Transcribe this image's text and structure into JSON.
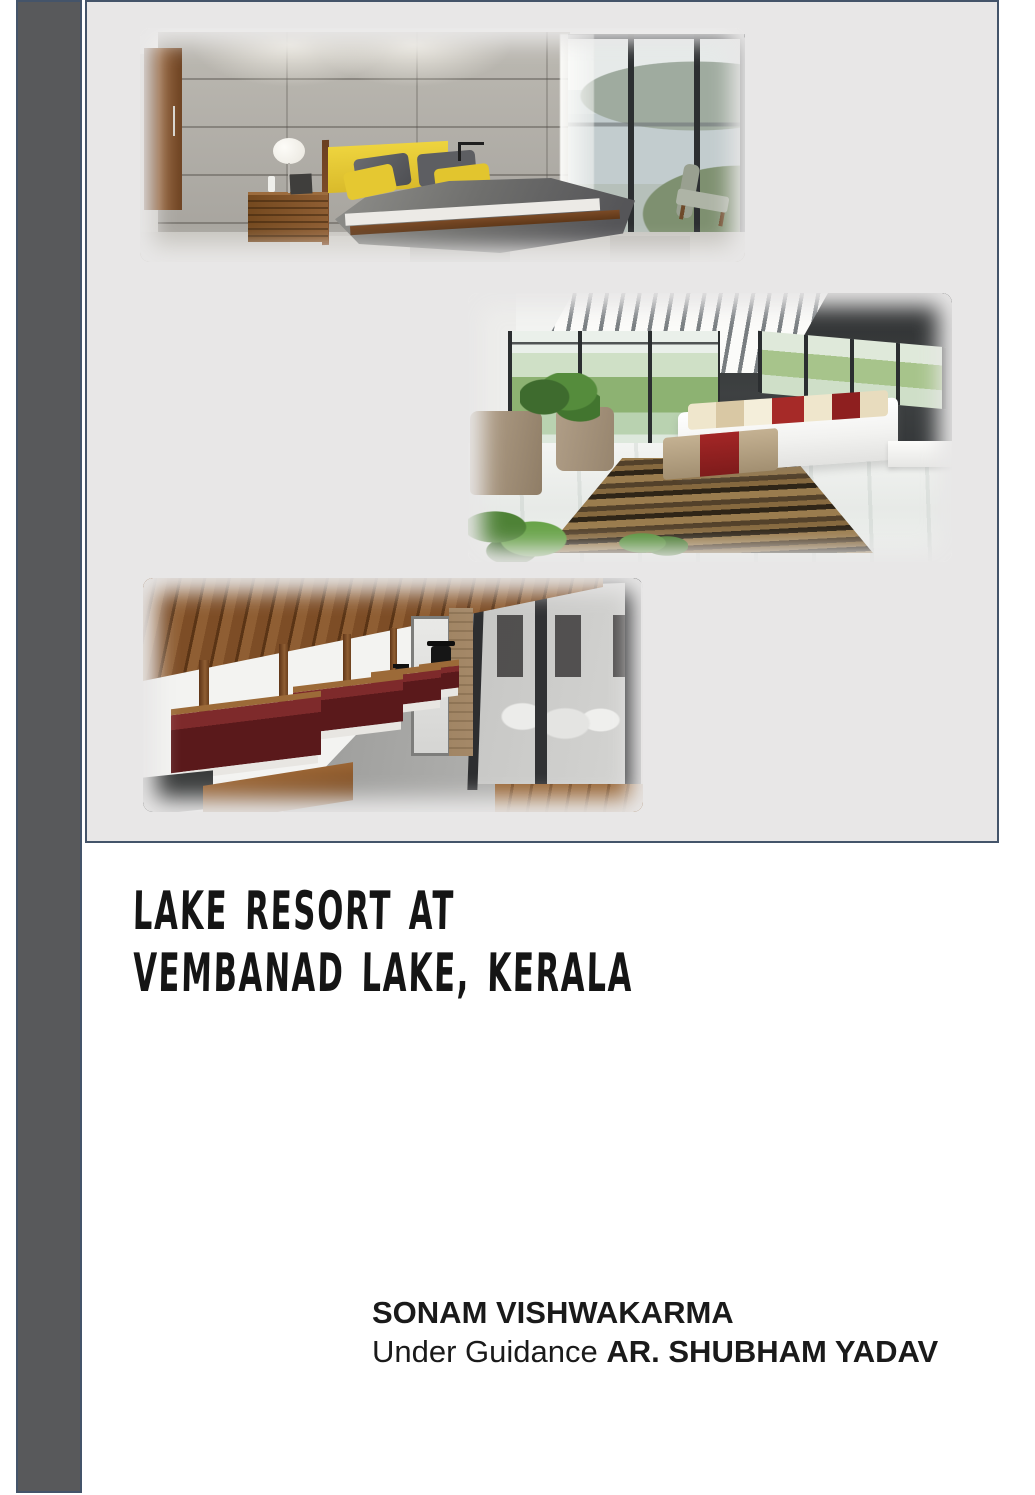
{
  "cover": {
    "title": {
      "line1": "LAKE RESORT AT",
      "line2": "VEMBANAD LAKE, KERALA"
    },
    "credits": {
      "author": "SONAM VISHWAKARMA",
      "guidance_prefix": "Under Guidance ",
      "guide_name": "AR. SHUBHAM YADAV"
    },
    "colors": {
      "page_background": "#FFFFFF",
      "accent_bar": "#58595B",
      "panel_background": "#E8E7E7",
      "panel_border": "#44546A",
      "title_text": "#151515",
      "credits_text": "#1A1A1A"
    },
    "images": [
      {
        "name": "bedroom-concrete-yellow-render"
      },
      {
        "name": "lakeview-bedroom-render"
      },
      {
        "name": "veranda-restaurant-render"
      }
    ]
  }
}
